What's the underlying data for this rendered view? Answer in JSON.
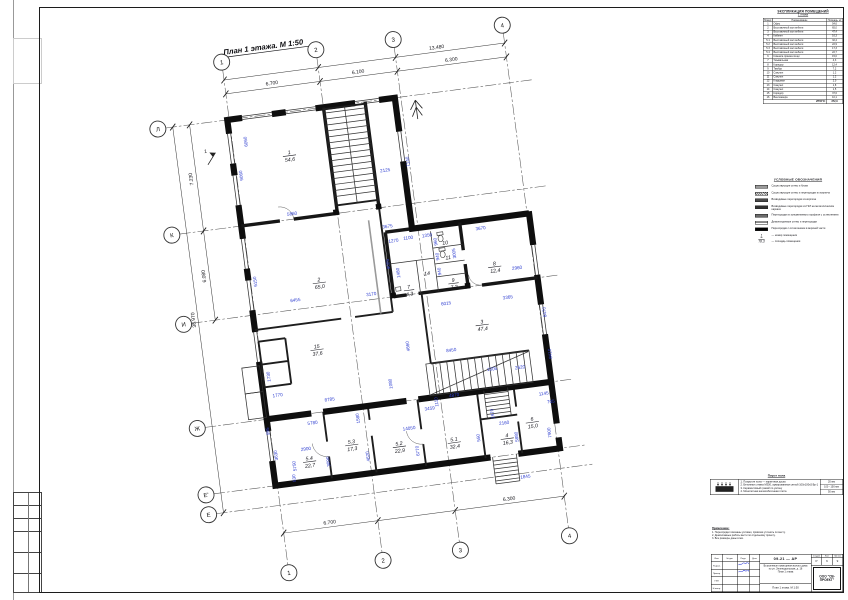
{
  "plan": {
    "title": "План 1 этажа. М 1:50",
    "bubbles": [
      {
        "l": "1",
        "x": 115,
        "y": 40
      },
      {
        "l": "2",
        "x": 210,
        "y": 40
      },
      {
        "l": "3",
        "x": 288,
        "y": 40
      },
      {
        "l": "4",
        "x": 398,
        "y": 40
      },
      {
        "l": "1",
        "x": 115,
        "y": 555
      },
      {
        "l": "2",
        "x": 210,
        "y": 555
      },
      {
        "l": "3",
        "x": 288,
        "y": 555
      },
      {
        "l": "4",
        "x": 398,
        "y": 555
      },
      {
        "l": "Л",
        "x": 43,
        "y": 98
      },
      {
        "l": "К",
        "x": 43,
        "y": 205
      },
      {
        "l": "И",
        "x": 43,
        "y": 295
      },
      {
        "l": "Ж",
        "x": 43,
        "y": 400
      },
      {
        "l": "Е'",
        "x": 43,
        "y": 467
      },
      {
        "l": "Е",
        "x": 43,
        "y": 487
      }
    ],
    "dims": [
      {
        "t": "13.480",
        "x": 330,
        "y": 55,
        "c": "axd"
      },
      {
        "t": "6.700",
        "x": 162,
        "y": 69,
        "c": "axd"
      },
      {
        "t": "6.100",
        "x": 249,
        "y": 69,
        "c": "axd"
      },
      {
        "t": "6.300",
        "x": 343,
        "y": 69,
        "c": "axd"
      },
      {
        "t": "7.230",
        "x": 71,
        "y": 152,
        "r": -90,
        "c": "axd"
      },
      {
        "t": "6.080",
        "x": 71,
        "y": 250,
        "r": -90,
        "c": "axd"
      },
      {
        "t": "38.970",
        "x": 55,
        "y": 292,
        "r": -90,
        "c": "axd"
      },
      {
        "t": "6.700",
        "x": 162,
        "y": 512,
        "c": "axd"
      },
      {
        "t": "6.300",
        "x": 343,
        "y": 512,
        "c": "axd"
      },
      {
        "t": "9060",
        "x": 121,
        "y": 155,
        "r": -90
      },
      {
        "t": "6060",
        "x": 130,
        "y": 122,
        "r": -90
      },
      {
        "t": "6150",
        "x": 121,
        "y": 262,
        "r": -90
      },
      {
        "t": "5860",
        "x": 165,
        "y": 201
      },
      {
        "t": "2125",
        "x": 263,
        "y": 170
      },
      {
        "t": "7140",
        "x": 288,
        "y": 163,
        "r": -90
      },
      {
        "t": "3675",
        "x": 258,
        "y": 226
      },
      {
        "t": "9005",
        "x": 255,
        "y": 262,
        "r": -90
      },
      {
        "t": "1270",
        "x": 262,
        "y": 241
      },
      {
        "t": "1100",
        "x": 277,
        "y": 240
      },
      {
        "t": "1350",
        "x": 296,
        "y": 240
      },
      {
        "t": "3670",
        "x": 350,
        "y": 240
      },
      {
        "t": "2960",
        "x": 381,
        "y": 284
      },
      {
        "t": "3365",
        "x": 368,
        "y": 312
      },
      {
        "t": "6470",
        "x": 404,
        "y": 330,
        "r": -90
      },
      {
        "t": "8410",
        "x": 404,
        "y": 372,
        "r": -90
      },
      {
        "t": "6455",
        "x": 157,
        "y": 287
      },
      {
        "t": "3170",
        "x": 233,
        "y": 291
      },
      {
        "t": "1480",
        "x": 264,
        "y": 272,
        "r": -90
      },
      {
        "t": "960",
        "x": 305,
        "y": 246,
        "r": -90
      },
      {
        "t": "940",
        "x": 305,
        "y": 261,
        "r": -90
      },
      {
        "t": "3005",
        "x": 322,
        "y": 260,
        "r": -90
      },
      {
        "t": "940",
        "x": 305,
        "y": 276,
        "r": -90
      },
      {
        "t": "6015",
        "x": 306,
        "y": 310
      },
      {
        "t": "4660",
        "x": 264,
        "y": 346,
        "r": -90
      },
      {
        "t": "8450",
        "x": 305,
        "y": 357
      },
      {
        "t": "1080",
        "x": 242,
        "y": 381,
        "r": -90
      },
      {
        "t": "2620",
        "x": 371,
        "y": 383
      },
      {
        "t": "1505",
        "x": 343,
        "y": 381
      },
      {
        "t": "1145",
        "x": 391,
        "y": 412
      },
      {
        "t": "705",
        "x": 397,
        "y": 421
      },
      {
        "t": "1970",
        "x": 339,
        "y": 424,
        "r": -90
      },
      {
        "t": "2160",
        "x": 348,
        "y": 436
      },
      {
        "t": "5880",
        "x": 360,
        "y": 450,
        "r": -90
      },
      {
        "t": "7900",
        "x": 393,
        "y": 450,
        "r": -90
      },
      {
        "t": "4870",
        "x": 302,
        "y": 402
      },
      {
        "t": "8785",
        "x": 178,
        "y": 390
      },
      {
        "t": "5780",
        "x": 158,
        "y": 411
      },
      {
        "t": "1580",
        "x": 205,
        "y": 411,
        "r": -90
      },
      {
        "t": "3459",
        "x": 276,
        "y": 412
      },
      {
        "t": "14050",
        "x": 253,
        "y": 429
      },
      {
        "t": "1110",
        "x": 285,
        "y": 405,
        "r": -90
      },
      {
        "t": "2900",
        "x": 148,
        "y": 436
      },
      {
        "t": "5750",
        "x": 136,
        "y": 450,
        "r": -90
      },
      {
        "t": "3090",
        "x": 170,
        "y": 450,
        "r": -90
      },
      {
        "t": "4620",
        "x": 210,
        "y": 450,
        "r": -90
      },
      {
        "t": "6770",
        "x": 260,
        "y": 451,
        "r": -90
      },
      {
        "t": "550",
        "x": 322,
        "y": 446,
        "r": -90
      },
      {
        "t": "995",
        "x": 114,
        "y": 412,
        "r": -90
      },
      {
        "t": "530",
        "x": 134,
        "y": 462,
        "r": -90
      },
      {
        "t": "1770",
        "x": 127,
        "y": 379
      },
      {
        "t": "1730",
        "x": 122,
        "y": 358,
        "r": -90
      },
      {
        "t": "3630",
        "x": 119,
        "y": 437,
        "r": -90
      },
      {
        "t": "1845",
        "x": 362,
        "y": 492
      }
    ],
    "rooms": [
      {
        "n": "1",
        "a": "54,6",
        "x": 170,
        "y": 140
      },
      {
        "n": "2",
        "a": "65,0",
        "x": 183,
        "y": 270
      },
      {
        "n": "3",
        "a": "47,4",
        "x": 339,
        "y": 333
      },
      {
        "n": "15",
        "a": "37,6",
        "x": 172,
        "y": 336
      },
      {
        "n": "5.1",
        "a": "32,4",
        "x": 296,
        "y": 446
      },
      {
        "n": "5.2",
        "a": "22,9",
        "x": 241,
        "y": 443
      },
      {
        "n": "5.3",
        "a": "17,3",
        "x": 194,
        "y": 435
      },
      {
        "n": "5.4",
        "a": "22,7",
        "x": 150,
        "y": 446
      },
      {
        "n": "4",
        "a": "16,3",
        "x": 349,
        "y": 449
      },
      {
        "n": "6",
        "a": "15,0",
        "x": 376,
        "y": 436
      },
      {
        "n": "7",
        "a": "4,3",
        "x": 271,
        "y": 289
      },
      {
        "n": "9",
        "a": "7,2",
        "x": 316,
        "y": 288
      },
      {
        "n": "8",
        "a": "12,4",
        "x": 359,
        "y": 277
      },
      {
        "n": "10",
        "a": "",
        "x": 313,
        "y": 250
      },
      {
        "n": "11",
        "a": "",
        "x": 314,
        "y": 265
      },
      {
        "n": "14",
        "a": "",
        "x": 291,
        "y": 278
      }
    ]
  },
  "explication": {
    "title_line1": "ЭКСПЛИКАЦИЯ ПОМЕЩЕНИЙ",
    "title_line2": "1 этажа",
    "col_headers": [
      "Номер помещ.",
      "Наименование",
      "Площадь, м²"
    ],
    "rows": [
      [
        "1",
        "Офис",
        "54,6"
      ],
      [
        "2",
        "Выставочный зал мебели",
        "65,0"
      ],
      [
        "3",
        "Выставочный зал мебели",
        "47,4"
      ],
      [
        "4",
        "Кабинет",
        "16,3"
      ],
      [
        "5.1",
        "Выставочный зал мебели",
        "32,4"
      ],
      [
        "5.2",
        "Выставочный зал мебели",
        "22,9"
      ],
      [
        "5.3",
        "Выставочный зал мебели",
        "17,3"
      ],
      [
        "5.4",
        "Выставочный зал мебели",
        "22,7"
      ],
      [
        "6",
        "Комната приема пищи",
        "15,0"
      ],
      [
        "7",
        "Умывальная",
        "4,3"
      ],
      [
        "8",
        "Коридор",
        "12,4"
      ],
      [
        "9",
        "Тамбур",
        "7,2"
      ],
      [
        "10",
        "Санузел",
        "1,2"
      ],
      [
        "11",
        "Санузел",
        "1,2"
      ],
      [
        "12",
        "Кладовая",
        "2,0"
      ],
      [
        "13",
        "Санузел",
        "1,8"
      ],
      [
        "14",
        "Санузел",
        "1,5"
      ],
      [
        "15",
        "Коридор",
        "37,6"
      ],
      [
        "16",
        "Венткамера",
        "10,1"
      ]
    ],
    "total_label": "ИТОГО:",
    "total_value": "372,9"
  },
  "legend": {
    "title": "УСЛОВНЫЕ ОБОЗНАЧЕНИЯ",
    "items": [
      {
        "swatch": "existing-wall",
        "label": "Существующие стены и блоки"
      },
      {
        "swatch": "existing-partition",
        "label": "Существующие стены и перегородки из кирпича"
      },
      {
        "swatch": "new-brick-partition",
        "label": "Возводимые перегородки из кирпича"
      },
      {
        "swatch": "new-gkl-partition",
        "label": "Возводимые перегородки из ГКЛ на металлическом каркасе"
      },
      {
        "swatch": "aluminium-partition",
        "label": "Перегородки из алюминиевого профиля с остеклением"
      },
      {
        "swatch": "demounted-partition",
        "label": "Демонтируемые стены и перегородки"
      },
      {
        "swatch": "glazed-partition",
        "label": "Перегородки с остеклением в верхней части"
      }
    ],
    "symbols": [
      {
        "sym": "1",
        "label": "номер помещения",
        "style": "under"
      },
      {
        "sym": "78,3",
        "label": "площадь помещения",
        "style": "over"
      }
    ]
  },
  "floor_pie": {
    "title": "Пирог пола",
    "items": [
      "1. Покрытие пола — паркетная доска",
      "2. Бетонная стяжка М300, армированная сеткой 100х100х5 Вр-1",
      "3. Керамзитовый гравий по уклону",
      "4. Монолитная железобетонная плита"
    ],
    "thickness": [
      "20 мм",
      "100 - 150 мм",
      "50 мм"
    ]
  },
  "notes": {
    "title": "Примечание:",
    "lines": [
      "1. Перегородки показаны условно, привязки уточнять по месту.",
      "2. Демонтажные работы вести по отдельному проекту.",
      "3. Все размеры даны в мм."
    ]
  },
  "titleblock": {
    "code": "09-21 — АР",
    "cols": [
      "Изм.",
      "Кол.уч",
      "Лист",
      "№ док.",
      "Подп.",
      "Дата"
    ],
    "staff": [
      "Разраб.",
      "Провер.",
      "ГИП",
      "Н.контр."
    ],
    "object_lines": [
      "Встроенные помещения жилого дома",
      "по ул. Зеленодольская, д. 16",
      "План 1 этажа"
    ],
    "sheet_title": "План 1 этажа. М 1:50",
    "stage_label": "Стадия",
    "sheet_label": "Лист",
    "sheets_label": "Листов",
    "stage": "Р",
    "sheet_no": "6",
    "sheets": "9",
    "org": "ООО \"СВ-ПРОЕКТ\""
  }
}
